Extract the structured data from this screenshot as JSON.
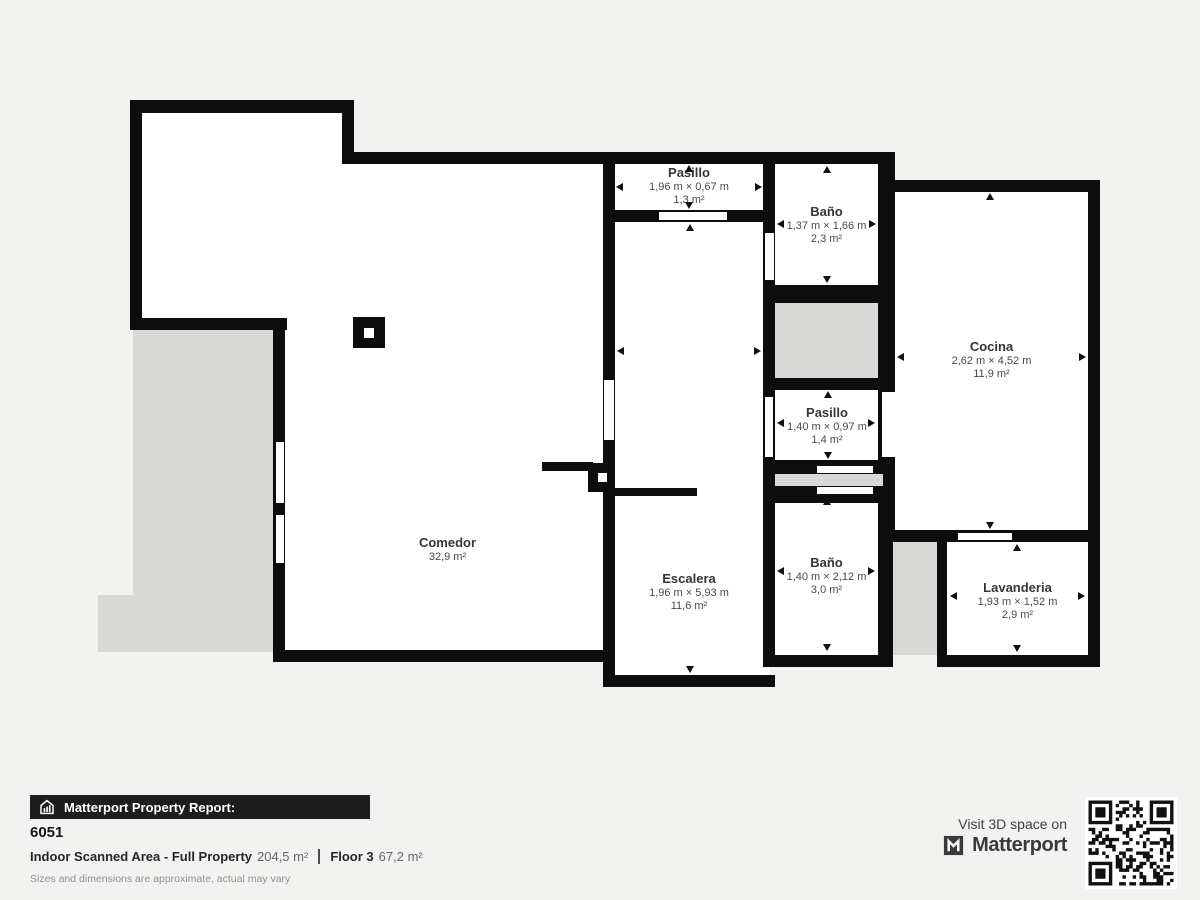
{
  "colors": {
    "wall": "#0d0d0d",
    "room_fill": "#ffffff",
    "void_gray": "#d8d8d6",
    "background": "#f2f2f0",
    "label_text": "#3b3b3b",
    "footer_bar": "#1d1d1d"
  },
  "plan": {
    "rooms": [
      {
        "name": "Pasillo",
        "dims": "1,96 m × 0,67 m",
        "area": "1,3 m²"
      },
      {
        "name": "Baño",
        "dims": "1,37 m × 1,66 m",
        "area": "2,3 m²"
      },
      {
        "name": "Cocina",
        "dims": "2,62 m × 4,52 m",
        "area": "11,9 m²"
      },
      {
        "name": "Pasillo",
        "dims": "1,40 m × 0,97 m",
        "area": "1,4 m²"
      },
      {
        "name": "Baño",
        "dims": "1,40 m × 2,12 m",
        "area": "3,0 m²"
      },
      {
        "name": "Lavanderia",
        "dims": "1,93 m × 1,52 m",
        "area": "2,9 m²"
      },
      {
        "name": "Escalera",
        "dims": "1,96 m × 5,93 m",
        "area": "11,6 m²"
      },
      {
        "name": "Comedor",
        "dims": "",
        "area": "32,9 m²"
      }
    ]
  },
  "footer": {
    "report_label": "Matterport Property Report:",
    "property_id": "6051",
    "scanned_label": "Indoor Scanned Area - Full Property",
    "scanned_value": "204,5 m²",
    "floor_label": "Floor 3",
    "floor_value": "67,2 m²",
    "disclaimer": "Sizes and dimensions are approximate, actual may vary"
  },
  "branding": {
    "visit_text": "Visit 3D space on",
    "brand_name": "Matterport"
  },
  "icons": {
    "report_icon": "house-chart-icon",
    "brand_icon": "matterport-logo",
    "qr": "qr-code",
    "measure_arrows": [
      "left-arrow",
      "right-arrow",
      "up-arrow",
      "down-arrow"
    ]
  }
}
